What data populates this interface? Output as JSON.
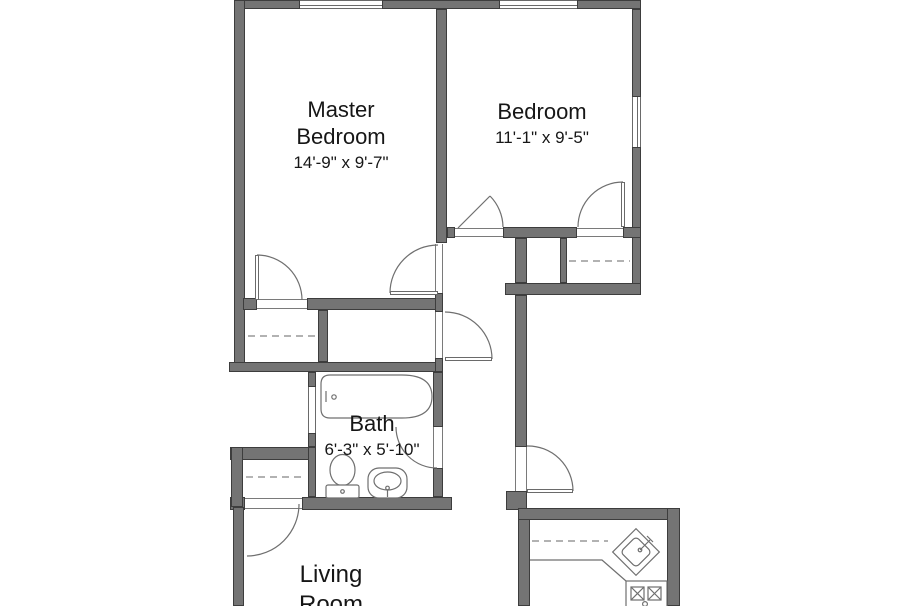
{
  "plan_title": "Apartment floor plan",
  "rooms": {
    "master_bedroom": {
      "name": "Master Bedroom",
      "dimensions": "14'-9\" x 9'-7\""
    },
    "bedroom": {
      "name": "Bedroom",
      "dimensions": "11'-1\" x 9'-5\""
    },
    "bath": {
      "name": "Bath",
      "dimensions": "6'-3\" x 5'-10\""
    },
    "living_room": {
      "name": "Living Room"
    }
  },
  "fixtures": [
    "bathtub",
    "toilet",
    "bathroom-sink",
    "kitchen-corner-sink",
    "stove",
    "closet-rods",
    "kitchen-counter"
  ],
  "colors": {
    "wall_fill": "#747474",
    "wall_outline": "#3d3d3d",
    "line": "#6f6f6f",
    "text": "#161616",
    "background": "#ffffff"
  }
}
